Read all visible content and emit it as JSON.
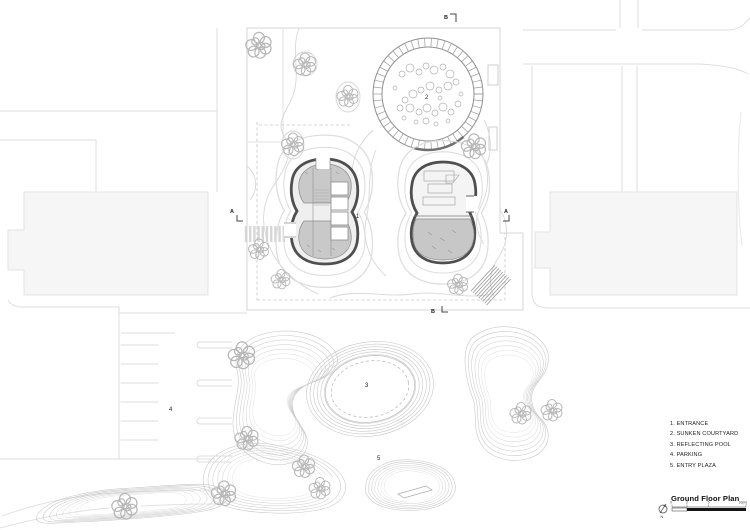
{
  "legend": {
    "items": [
      "1. ENTRANCE",
      "2. SUNKEN COURTYARD",
      "3. REFLECTING POOL",
      "4. PARKING",
      "5. ENTRY PLAZA"
    ]
  },
  "title_block": {
    "title": "Ground Floor Plan",
    "north_label": "N",
    "scale_ticks": [
      "0",
      "2",
      "5",
      "10(m)"
    ]
  },
  "plan_labels": {
    "entrance": "1",
    "sunken_courtyard": "2",
    "reflecting_pool": "3",
    "parking": "4",
    "entry_plaza": "5"
  },
  "section_markers": {
    "a_left": "A",
    "a_right": "A",
    "b_top": "B",
    "b_bottom": "B"
  },
  "colors": {
    "building_outline": "#4f4f4f",
    "building_fill": "#c9c9c9",
    "context_fill": "#f6f6f6",
    "contour_line": "#c8c8c8",
    "street_line": "#dedede"
  }
}
